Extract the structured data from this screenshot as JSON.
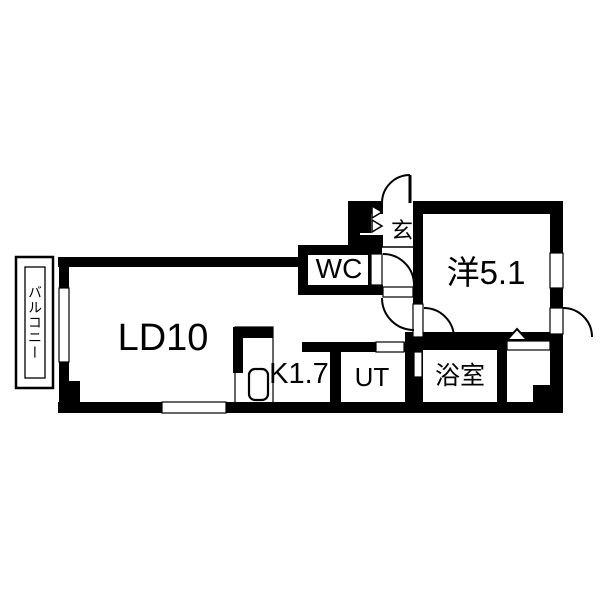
{
  "plan_title": "1LDK floor plan",
  "rooms": {
    "balcony": "バルコニー",
    "living_dining": "LD10",
    "toilet": "WC",
    "entrance": "玄",
    "western_room": "洋5.1",
    "kitchen": "K1.7",
    "utility": "UT",
    "bathroom": "浴室"
  },
  "colors": {
    "wall": "#000000",
    "floor": "#ffffff"
  }
}
